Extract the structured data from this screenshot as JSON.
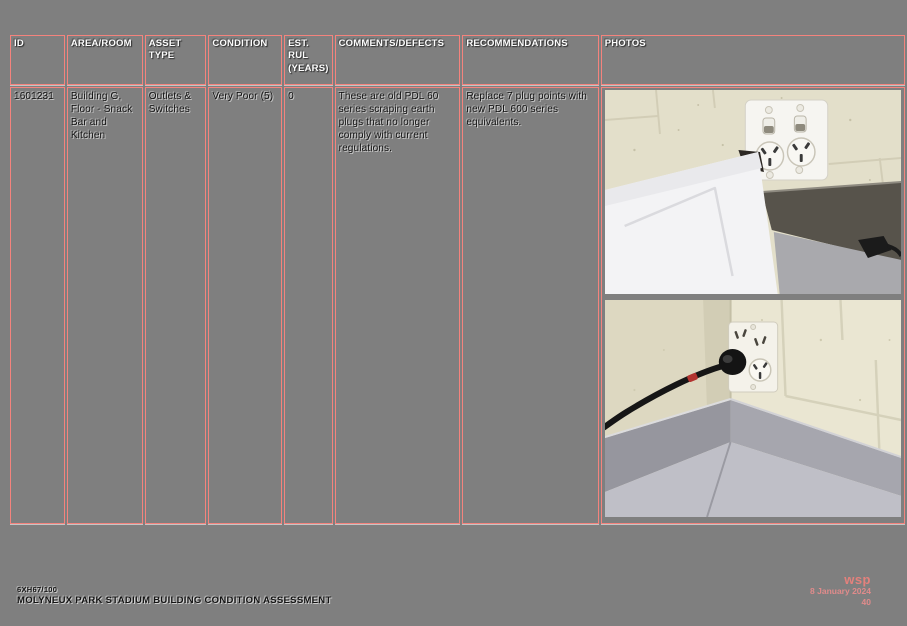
{
  "table": {
    "headers": [
      "ID",
      "AREA/ROOM",
      "ASSET TYPE",
      "CONDITION",
      "EST. RUL (YEARS)",
      "COMMENTS/DEFECTS",
      "RECOMMENDATIONS",
      "PHOTOS"
    ],
    "row": {
      "id": "1601231",
      "area_room": "Building G, Floor - Snack Bar and Kitchen",
      "asset_type": "Outlets & Switches",
      "condition": "Very Poor (5)",
      "est_rul_years": "0",
      "comments_defects": "These are old PDL 60 series scraping earth plugs that no longer comply with current regulations.",
      "recommendations": "Replace 7 plug points with new PDL 600 series equivalents."
    }
  },
  "photos": {
    "items": [
      "double-outlet-above-chest-freezer",
      "corner-outlet-with-plugged-cable"
    ]
  },
  "footer": {
    "project_number": "6XH67/100",
    "document_title": "MOLYNEUX PARK STADIUM BUILDING CONDITION ASSESSMENT",
    "logo": "wsp",
    "date": "8 January 2024",
    "page_number": "40"
  },
  "colors": {
    "page_background": "#7f7f7f",
    "table_border": "#f4837d",
    "condition_very_poor": "#fb0200",
    "footer_accent": "#e08b8b"
  }
}
